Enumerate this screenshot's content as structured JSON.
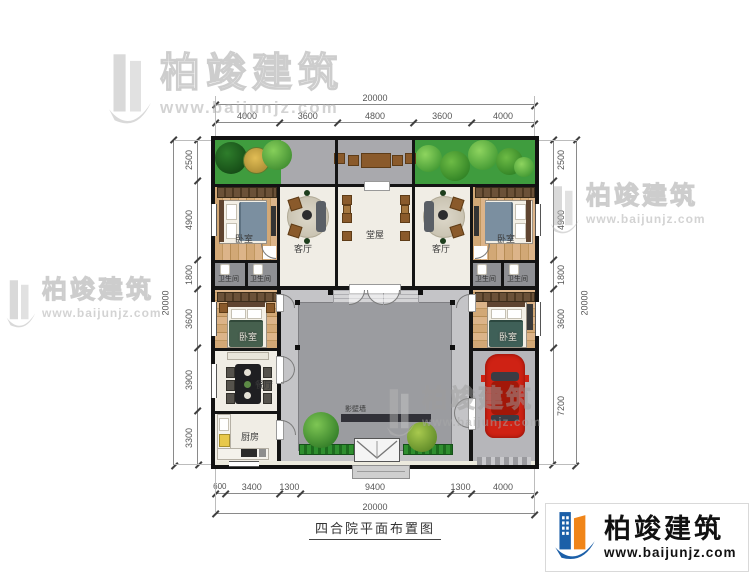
{
  "title": "四合院平面布置图",
  "brand": {
    "name": "柏竣建筑",
    "url": "www.baijunjz.com"
  },
  "watermark": {
    "name": "柏竣建筑",
    "url": "www.baijunjz.com"
  },
  "rooms": {
    "bedroom": "卧室",
    "living": "客厅",
    "hall": "堂屋",
    "bathroom": "卫生间",
    "dining": "餐厅",
    "kitchen": "厨房",
    "screen_wall": "影壁墙"
  },
  "dims": {
    "top": {
      "total": "20000",
      "segments": [
        "4000",
        "3600",
        "4800",
        "3600",
        "4000"
      ]
    },
    "bottom": {
      "total": "20000",
      "segments": [
        "600",
        "3400",
        "1300",
        "9400",
        "1300",
        "4000"
      ]
    },
    "left": {
      "total": "20000",
      "segments": [
        "2500",
        "4900",
        "1800",
        "3600",
        "3900",
        "3300"
      ]
    },
    "right": {
      "total": "20000",
      "segments": [
        "2500",
        "4900",
        "1800",
        "3600",
        "7200"
      ]
    }
  },
  "colors": {
    "wall": "#141414",
    "courtyard": "#9b9ca0",
    "walkway": "#c4c4c7",
    "garden": "#3f9c3e",
    "cream": "#f0ede5",
    "wood": "#cda571",
    "accent_blue": "#1b5fa8",
    "accent_orange": "#f08519",
    "car": "#cf2214"
  }
}
